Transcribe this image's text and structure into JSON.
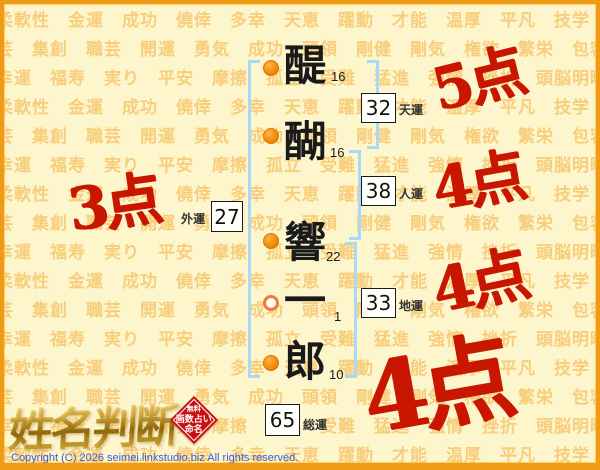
{
  "background": {
    "words": [
      "柔軟性",
      "金運",
      "成功",
      "僥倖",
      "多幸",
      "天恵",
      "躍動",
      "才能",
      "温厚",
      "平凡",
      "技学",
      "技芸",
      "集創",
      "職芸",
      "開運",
      "勇気",
      "成功",
      "頭領",
      "剛健",
      "剛気",
      "権欲",
      "繁栄",
      "包容力",
      "幸運",
      "福寿",
      "実り",
      "平安",
      "摩擦",
      "孤立",
      "受難",
      "猛進",
      "強情",
      "挫折",
      "頭脳明晰"
    ],
    "repeat": 12
  },
  "name_column": {
    "characters": [
      {
        "char": "醍",
        "strokes": "16",
        "dot": "solid"
      },
      {
        "char": "醐",
        "strokes": "16",
        "dot": "solid"
      },
      {
        "char": "響",
        "strokes": "22",
        "dot": "solid"
      },
      {
        "char": "一",
        "strokes": "1",
        "dot": "open"
      },
      {
        "char": "郎",
        "strokes": "10",
        "dot": "solid"
      }
    ]
  },
  "fortunes": [
    {
      "id": "ten",
      "value": "32",
      "label": "天運",
      "score": "5点"
    },
    {
      "id": "jin",
      "value": "38",
      "label": "人運",
      "score": "4点"
    },
    {
      "id": "gai",
      "value": "27",
      "label": "外運",
      "score": "3点"
    },
    {
      "id": "chi",
      "value": "33",
      "label": "地運",
      "score": "4点"
    },
    {
      "id": "sou",
      "value": "65",
      "label": "総運",
      "score": "4点"
    }
  ],
  "logo": {
    "title": "姓名判断",
    "badge": {
      "line1": "無料",
      "line2": "画数占い",
      "line3": "命名"
    }
  },
  "footer": {
    "copyright": "Copyright (C) 2026 seimei.linkstudio.biz All rights reserved."
  },
  "colors": {
    "frame_orange": "#f09b16",
    "background_cream": "#fdf5cc",
    "word_tint": "#f6c162",
    "bracket_blue": "#a9d9f7",
    "score_red": "#c81600",
    "dot_orange": "#ef8200",
    "copyright_blue": "#3b5bd6",
    "badge_red": "#c90f0f"
  }
}
